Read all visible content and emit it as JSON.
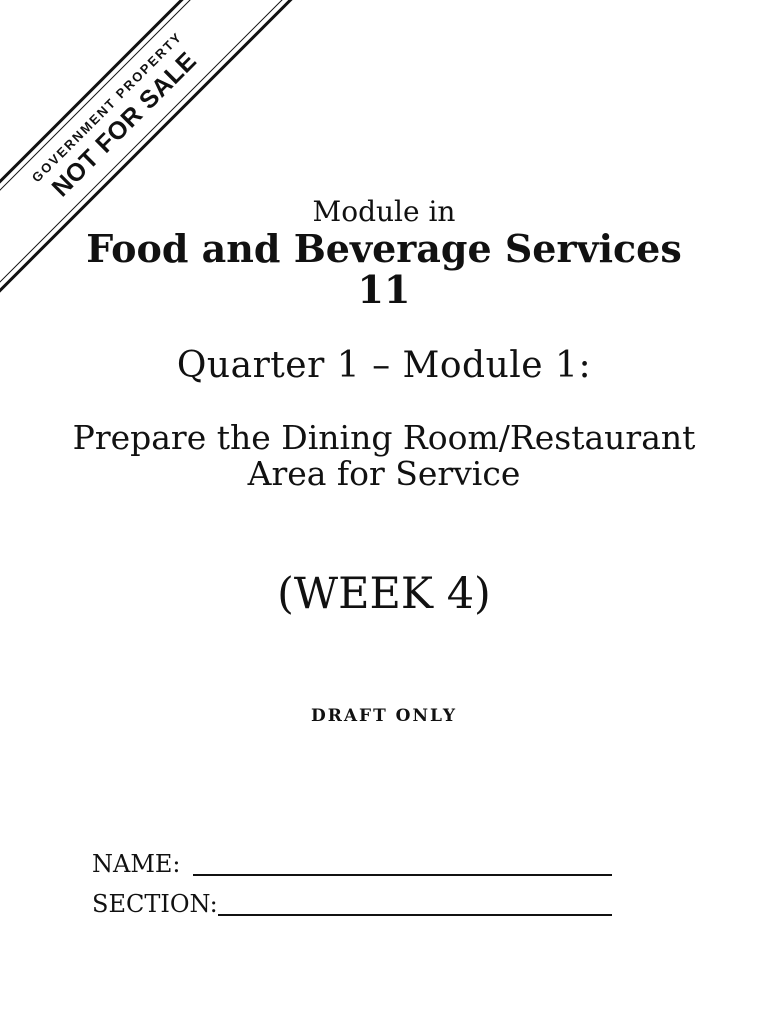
{
  "banner": {
    "top_label": "GOVERNMENT PROPERTY",
    "bottom_label": "NOT FOR SALE"
  },
  "header": {
    "eyebrow": "Module in",
    "title": "Food and Beverage Services",
    "grade_level": "11"
  },
  "module": {
    "quarter_title": "Quarter 1 – Module 1:",
    "topic_line1": "Prepare the Dining Room/Restaurant",
    "topic_line2": "Area for Service",
    "week": "(WEEK 4)",
    "draft_note": "DRAFT ONLY"
  },
  "fields": {
    "name_label": "NAME:",
    "section_label": "SECTION:"
  },
  "colors": {
    "ink": "#111111",
    "paper": "#ffffff"
  }
}
